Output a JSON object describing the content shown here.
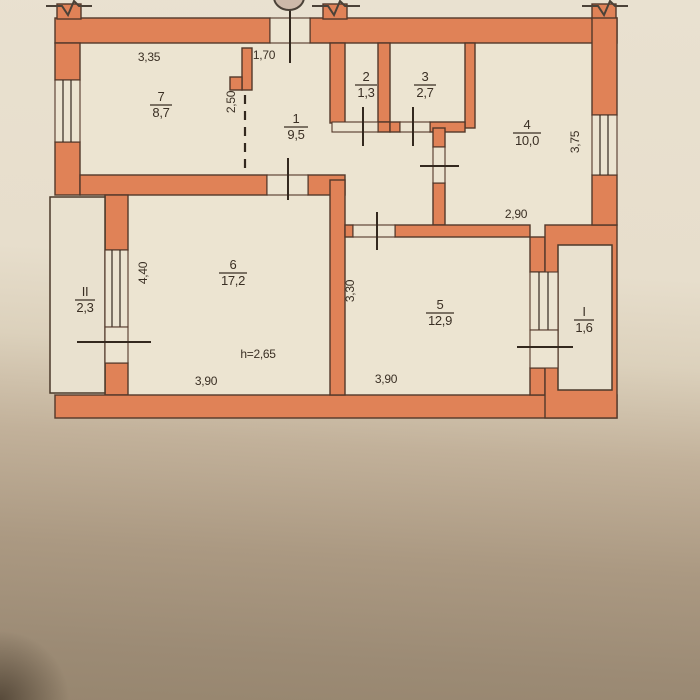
{
  "rooms": [
    {
      "id": "room-7",
      "number": "7",
      "area": "8,7"
    },
    {
      "id": "room-1",
      "number": "1",
      "area": "9,5"
    },
    {
      "id": "room-2",
      "number": "2",
      "area": "1,3"
    },
    {
      "id": "room-3",
      "number": "3",
      "area": "2,7"
    },
    {
      "id": "room-4",
      "number": "4",
      "area": "10,0"
    },
    {
      "id": "room-6",
      "number": "6",
      "area": "17,2"
    },
    {
      "id": "room-5",
      "number": "5",
      "area": "12,9"
    },
    {
      "id": "balcony-ii",
      "number": "II",
      "area": "2,3"
    },
    {
      "id": "balcony-i",
      "number": "I",
      "area": "1,6"
    }
  ],
  "dimensions": [
    {
      "id": "dim-width-room7",
      "text": "3,35"
    },
    {
      "id": "dim-entry",
      "text": "1,70"
    },
    {
      "id": "dim-hall-depth",
      "text": "2,50"
    },
    {
      "id": "dim-room4-height",
      "text": "3,75"
    },
    {
      "id": "dim-room4-width",
      "text": "2,90"
    },
    {
      "id": "dim-room6-height",
      "text": "4,40"
    },
    {
      "id": "dim-room5-height",
      "text": "3,30"
    },
    {
      "id": "dim-room6-width",
      "text": "3,90"
    },
    {
      "id": "dim-room5-width",
      "text": "3,90"
    },
    {
      "id": "dim-ceiling-height",
      "text": "h=2,65"
    }
  ],
  "colors": {
    "wall_fill": "#e08257",
    "wall_outline": "#53382a",
    "paper_light": "#e9e1d0",
    "paper_dark": "#97866f",
    "line": "#33281e"
  }
}
